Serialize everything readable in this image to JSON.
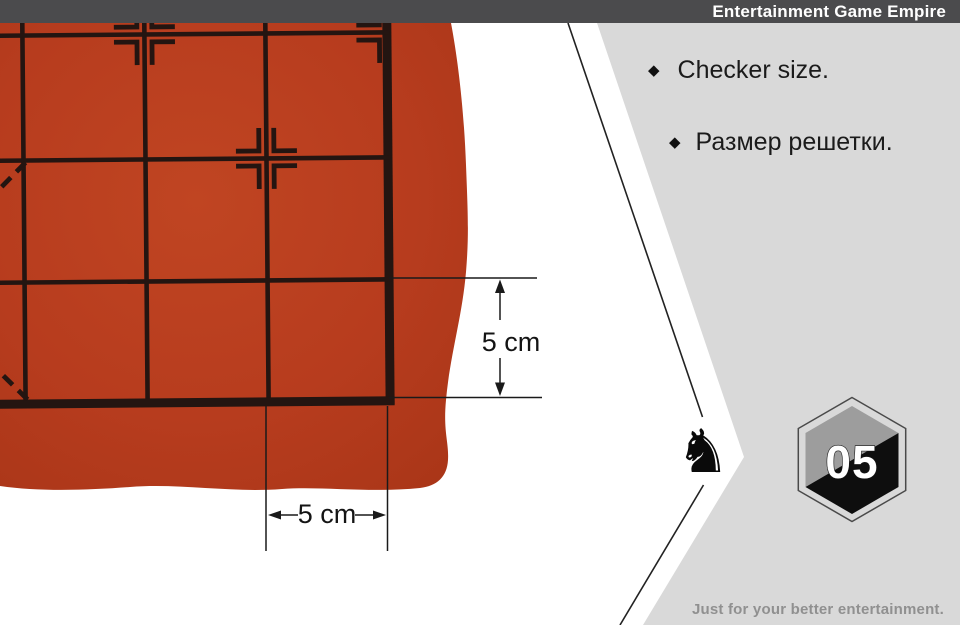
{
  "banner": {
    "title": "Entertainment Game Empire"
  },
  "sidebar": {
    "bullets": [
      {
        "marker": "◆",
        "label": "Checker size."
      },
      {
        "marker": "◆",
        "label": "Размер решетки."
      }
    ],
    "step_badge": {
      "number": "05"
    },
    "knight_glyph": "♞",
    "footer": "Just for your better entertainment."
  },
  "diagram": {
    "cell_height_label": "5 cm",
    "cell_width_label": "5 cm"
  },
  "colors": {
    "banner_bg": "#4b4b4d",
    "panel_bg": "#d9d9d9",
    "mat_fabric": "#b83d1e",
    "grid_lines": "#241511",
    "dimension_lines": "#1a1a1a",
    "footer_text": "#909090",
    "badge_gray": "#9d9d9d",
    "badge_black": "#0e0e0e"
  }
}
